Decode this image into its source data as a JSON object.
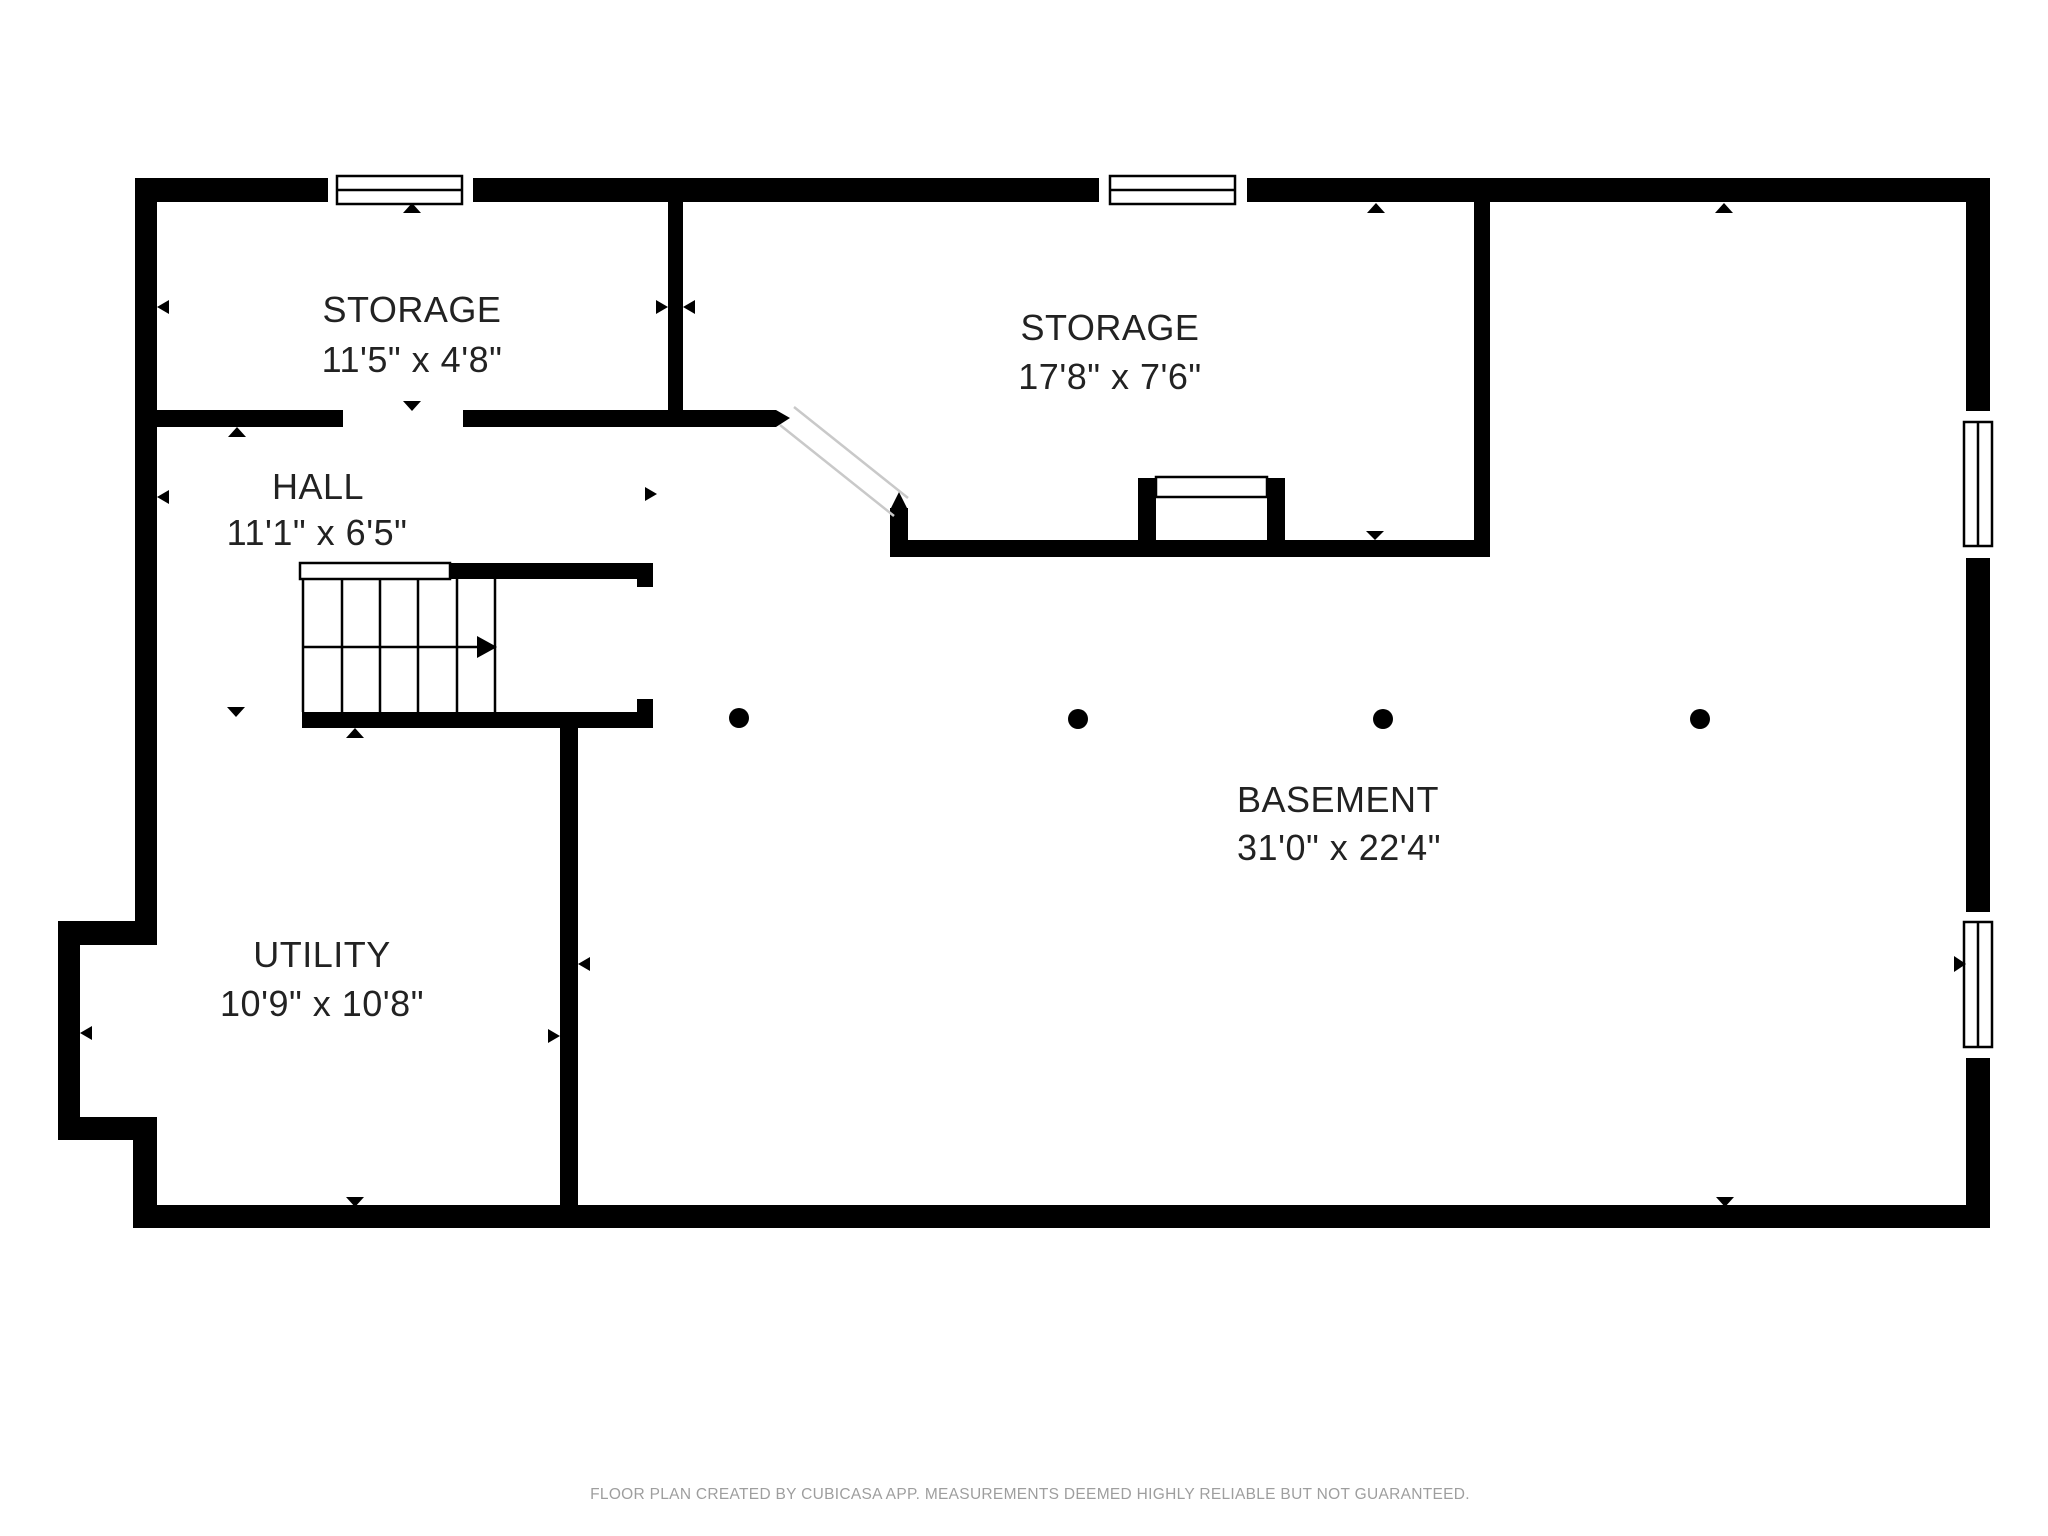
{
  "rooms": {
    "storage_small": {
      "name": "STORAGE",
      "dims": "11'5\" x 4'8\""
    },
    "storage_large": {
      "name": "STORAGE",
      "dims": "17'8\" x 7'6\""
    },
    "hall": {
      "name": "HALL",
      "dims": "11'1\" x 6'5\""
    },
    "utility": {
      "name": "UTILITY",
      "dims": "10'9\" x 10'8\""
    },
    "basement": {
      "name": "BASEMENT",
      "dims": "31'0\" x 22'4\""
    }
  },
  "footer": {
    "text": "FLOOR PLAN CREATED BY CUBICASA APP. MEASUREMENTS DEEMED HIGHLY RELIABLE BUT NOT GUARANTEED."
  },
  "icons": [
    "window-icon",
    "stairs-icon",
    "stair-direction-arrow-icon",
    "door-swing-icon",
    "direction-arrow-icon",
    "column-dot-icon"
  ],
  "colors": {
    "wall": "#000000",
    "background": "#ffffff",
    "label": "#222222",
    "footer": "#9e9e9e",
    "door_leaf": "#c9c9c9"
  }
}
